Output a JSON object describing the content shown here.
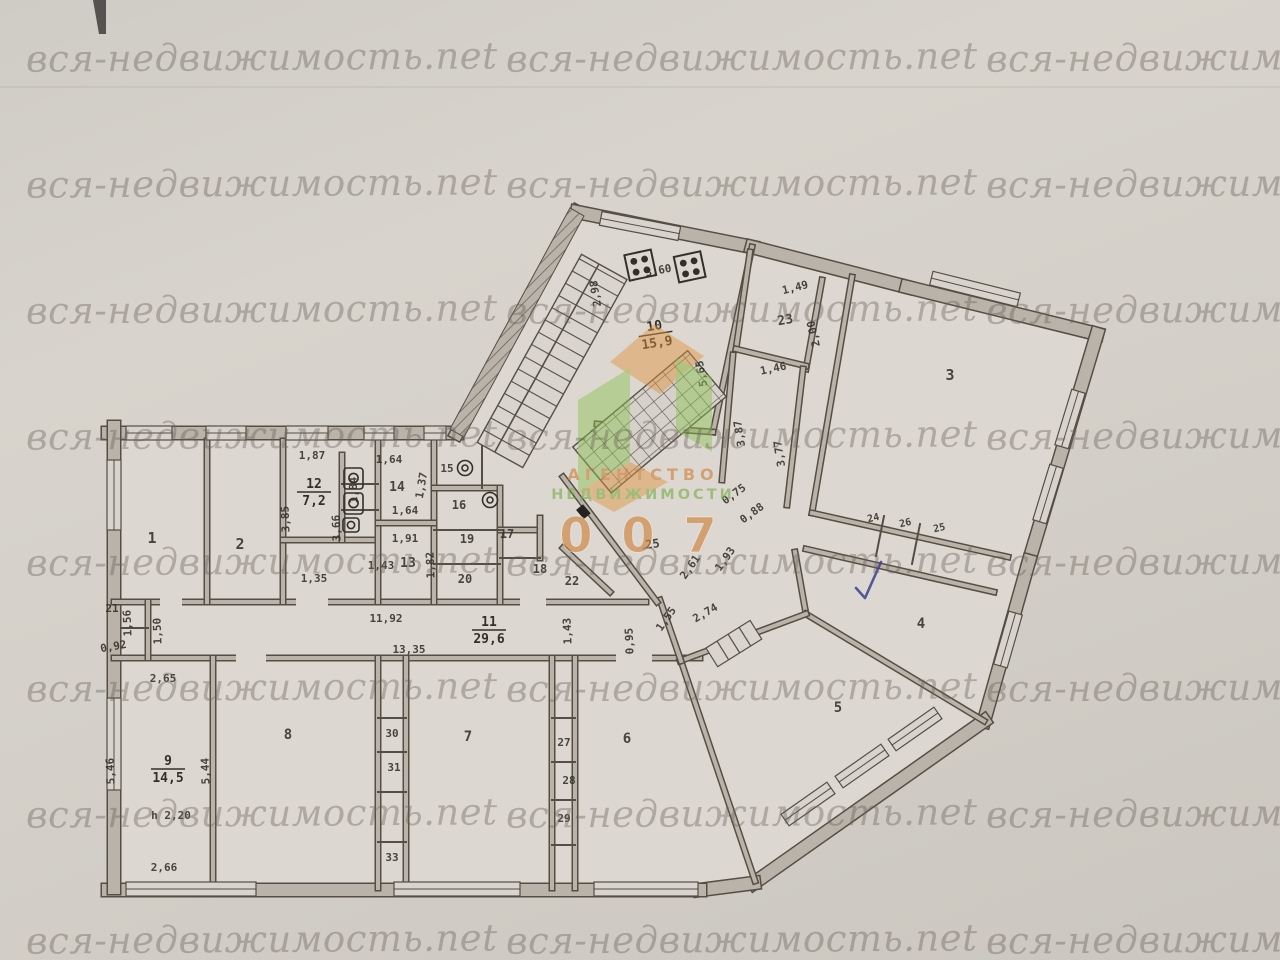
{
  "watermark": {
    "text": "вся-недвижимость.net",
    "color": "rgba(106,98,90,0.40)",
    "columns": [
      26,
      506,
      986
    ],
    "rows": [
      60,
      186,
      312,
      438,
      564,
      690,
      816,
      942
    ]
  },
  "logo": {
    "line1": "АГЕНТСТВО",
    "line2": "НЕДВИЖИМОСТИ",
    "number": "0 0 7",
    "orange": "#cf8138",
    "green": "#79ad49"
  },
  "plan": {
    "wall_fill": "#b9b3a9",
    "wall_edge": "#544e45",
    "text_color": "#33302a",
    "check_color": "#3b418f",
    "room_labels": [
      {
        "t": "1",
        "x": 152,
        "y": 543,
        "s": 15
      },
      {
        "t": "2",
        "x": 240,
        "y": 549,
        "s": 15
      },
      {
        "t": "3",
        "x": 950,
        "y": 380,
        "s": 15
      },
      {
        "t": "4",
        "x": 921,
        "y": 628,
        "s": 14
      },
      {
        "t": "5",
        "x": 838,
        "y": 712,
        "s": 14
      },
      {
        "t": "6",
        "x": 627,
        "y": 743,
        "s": 14
      },
      {
        "t": "7",
        "x": 468,
        "y": 741,
        "s": 14
      },
      {
        "t": "8",
        "x": 288,
        "y": 739,
        "s": 14
      },
      {
        "t": "13",
        "x": 408,
        "y": 567,
        "s": 13
      },
      {
        "t": "14",
        "x": 397,
        "y": 491,
        "s": 13
      },
      {
        "t": "15",
        "x": 447,
        "y": 472,
        "s": 11
      },
      {
        "t": "16",
        "x": 459,
        "y": 509,
        "s": 12
      },
      {
        "t": "17",
        "x": 507,
        "y": 538,
        "s": 12
      },
      {
        "t": "18",
        "x": 540,
        "y": 573,
        "s": 12
      },
      {
        "t": "19",
        "x": 467,
        "y": 543,
        "s": 12
      },
      {
        "t": "20",
        "x": 465,
        "y": 583,
        "s": 12
      },
      {
        "t": "21",
        "x": 112,
        "y": 612,
        "s": 11
      },
      {
        "t": "22",
        "x": 572,
        "y": 585,
        "s": 12
      },
      {
        "t": "23",
        "x": 786,
        "y": 324,
        "s": 13,
        "r": -10
      },
      {
        "t": "24",
        "x": 874,
        "y": 521,
        "s": 10,
        "r": -13
      },
      {
        "t": "26",
        "x": 906,
        "y": 526,
        "s": 10,
        "r": -13
      },
      {
        "t": "25",
        "x": 940,
        "y": 531,
        "s": 10,
        "r": -13
      },
      {
        "t": "25",
        "x": 653,
        "y": 548,
        "s": 12,
        "r": -8
      },
      {
        "t": "27",
        "x": 564,
        "y": 746,
        "s": 11
      },
      {
        "t": "28",
        "x": 569,
        "y": 784,
        "s": 11
      },
      {
        "t": "29",
        "x": 564,
        "y": 822,
        "s": 11
      },
      {
        "t": "30",
        "x": 392,
        "y": 737,
        "s": 11
      },
      {
        "t": "31",
        "x": 394,
        "y": 771,
        "s": 11
      },
      {
        "t": "33",
        "x": 392,
        "y": 861,
        "s": 11
      }
    ],
    "area_labels": [
      {
        "num": "10",
        "den": "15,9",
        "x": 655,
        "y": 330,
        "r": -9
      },
      {
        "num": "12",
        "den": "7,2",
        "x": 314,
        "y": 488,
        "r": 0
      },
      {
        "num": "11",
        "den": "29,6",
        "x": 489,
        "y": 626,
        "r": 0
      },
      {
        "num": "9",
        "den": "14,5",
        "x": 168,
        "y": 765,
        "r": 0
      }
    ],
    "dim_labels": [
      {
        "t": "2,98",
        "x": 599,
        "y": 293,
        "r": -99
      },
      {
        "t": "3,60",
        "x": 659,
        "y": 274,
        "r": -11
      },
      {
        "t": "1,49",
        "x": 796,
        "y": 291,
        "r": -14
      },
      {
        "t": "2,00",
        "x": 817,
        "y": 333,
        "r": -103
      },
      {
        "t": "1,46",
        "x": 774,
        "y": 372,
        "r": -12
      },
      {
        "t": "5,65",
        "x": 705,
        "y": 373,
        "r": -100
      },
      {
        "t": "3,87",
        "x": 743,
        "y": 433,
        "r": -99
      },
      {
        "t": "3,77",
        "x": 783,
        "y": 453,
        "r": -99
      },
      {
        "t": "0,75",
        "x": 736,
        "y": 497,
        "r": -36
      },
      {
        "t": "0,88",
        "x": 754,
        "y": 516,
        "r": -36
      },
      {
        "t": "1,93",
        "x": 728,
        "y": 561,
        "r": -55
      },
      {
        "t": "2,61",
        "x": 693,
        "y": 569,
        "r": -55
      },
      {
        "t": "2,74",
        "x": 707,
        "y": 616,
        "r": -30
      },
      {
        "t": "1,55",
        "x": 669,
        "y": 621,
        "r": -55
      },
      {
        "t": "0,95",
        "x": 633,
        "y": 641,
        "r": -92
      },
      {
        "t": "1,43",
        "x": 571,
        "y": 631,
        "r": -92
      },
      {
        "t": "11,92",
        "x": 386,
        "y": 622,
        "r": 0
      },
      {
        "t": "13,35",
        "x": 409,
        "y": 653,
        "r": 0
      },
      {
        "t": "1,87",
        "x": 312,
        "y": 459,
        "r": 0
      },
      {
        "t": "1,64",
        "x": 389,
        "y": 463,
        "r": 0
      },
      {
        "t": "1,84",
        "x": 357,
        "y": 490,
        "r": -92
      },
      {
        "t": "1,37",
        "x": 425,
        "y": 486,
        "r": -80
      },
      {
        "t": "1,64",
        "x": 405,
        "y": 514,
        "r": 0
      },
      {
        "t": "1,91",
        "x": 405,
        "y": 542,
        "r": 0
      },
      {
        "t": "1,82",
        "x": 434,
        "y": 565,
        "r": -92
      },
      {
        "t": "1,43",
        "x": 381,
        "y": 569,
        "r": 0
      },
      {
        "t": "3,85",
        "x": 289,
        "y": 519,
        "r": -92
      },
      {
        "t": "3,66",
        "x": 340,
        "y": 528,
        "r": -92
      },
      {
        "t": "1,35",
        "x": 314,
        "y": 582,
        "r": 0
      },
      {
        "t": "1,56",
        "x": 131,
        "y": 623,
        "r": -92
      },
      {
        "t": "1,50",
        "x": 161,
        "y": 631,
        "r": -92
      },
      {
        "t": "0,92",
        "x": 114,
        "y": 650,
        "r": -10
      },
      {
        "t": "2,65",
        "x": 163,
        "y": 682,
        "r": 0
      },
      {
        "t": "5,46",
        "x": 114,
        "y": 771,
        "r": -92
      },
      {
        "t": "5,44",
        "x": 209,
        "y": 771,
        "r": -92
      },
      {
        "t": "h 2,20",
        "x": 171,
        "y": 819,
        "r": 0
      },
      {
        "t": "2,66",
        "x": 164,
        "y": 871,
        "r": 0
      }
    ]
  }
}
